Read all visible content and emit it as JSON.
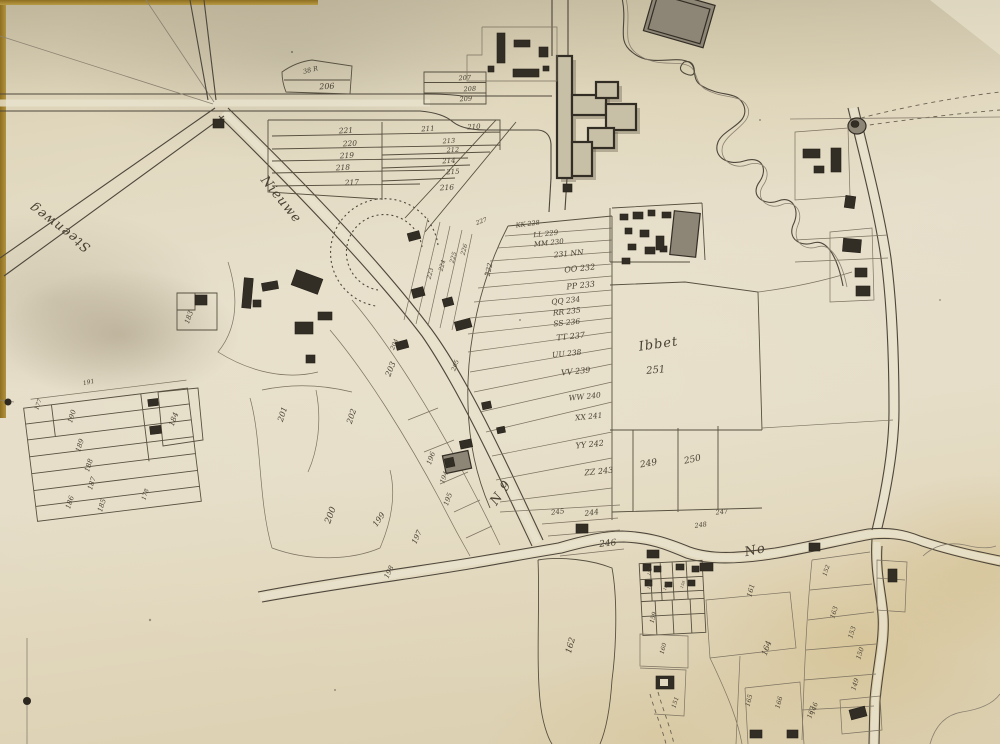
{
  "document": {
    "type": "hand-drawn cadastral survey map",
    "era_style": "ink on aged sepia paper, numbered land parcels, farm buildings, church, winding stream"
  },
  "map": {
    "colors": {
      "paper": "#e2d9c0",
      "ink": "#4a4234",
      "building": "#332e25",
      "stain": "#c9ae6a"
    },
    "labels": {
      "roads": [
        {
          "t": "Steenweg",
          "x": 62,
          "y": 224,
          "r": 217,
          "s": 13
        },
        {
          "t": "Nieuwe",
          "x": 278,
          "y": 202,
          "r": 51,
          "s": 12
        }
      ],
      "places": [
        {
          "t": "Ibbet",
          "x": 659,
          "y": 348,
          "r": -8,
          "s": 15
        },
        {
          "t": "No",
          "x": 756,
          "y": 554,
          "r": -12,
          "s": 12
        },
        {
          "t": "N 9",
          "x": 504,
          "y": 495,
          "r": -55,
          "s": 10
        }
      ],
      "parcels": [
        {
          "t": "38 R",
          "x": 311,
          "y": 72,
          "r": -14,
          "s": 6.5
        },
        {
          "t": "206",
          "x": 327,
          "y": 89,
          "r": -3,
          "s": 8
        },
        {
          "t": "207",
          "x": 465,
          "y": 80,
          "r": -4,
          "s": 6.5
        },
        {
          "t": "208",
          "x": 470,
          "y": 91,
          "r": -4,
          "s": 6.5
        },
        {
          "t": "209",
          "x": 466,
          "y": 101,
          "r": -4,
          "s": 6.5
        },
        {
          "t": "221",
          "x": 346,
          "y": 133,
          "r": -3,
          "s": 7.5
        },
        {
          "t": "220",
          "x": 350,
          "y": 146,
          "r": -3,
          "s": 7.5
        },
        {
          "t": "219",
          "x": 347,
          "y": 158,
          "r": -3,
          "s": 7.5
        },
        {
          "t": "218",
          "x": 343,
          "y": 170,
          "r": -3,
          "s": 7.5
        },
        {
          "t": "217",
          "x": 352,
          "y": 185,
          "r": -3,
          "s": 7.5
        },
        {
          "t": "211",
          "x": 428,
          "y": 131,
          "r": -3,
          "s": 7
        },
        {
          "t": "210",
          "x": 474,
          "y": 129,
          "r": -3,
          "s": 7
        },
        {
          "t": "213",
          "x": 449,
          "y": 143,
          "r": -3,
          "s": 6.5
        },
        {
          "t": "212",
          "x": 453,
          "y": 152,
          "r": -3,
          "s": 6.5
        },
        {
          "t": "214",
          "x": 449,
          "y": 163,
          "r": -3,
          "s": 7
        },
        {
          "t": "215",
          "x": 453,
          "y": 174,
          "r": -3,
          "s": 7
        },
        {
          "t": "216",
          "x": 447,
          "y": 190,
          "r": -3,
          "s": 7.5
        },
        {
          "t": "227",
          "x": 482,
          "y": 223,
          "r": -20,
          "s": 6
        },
        {
          "t": "226",
          "x": 466,
          "y": 250,
          "r": -75,
          "s": 6
        },
        {
          "t": "225",
          "x": 455,
          "y": 258,
          "r": -75,
          "s": 6
        },
        {
          "t": "224",
          "x": 444,
          "y": 266,
          "r": -75,
          "s": 6
        },
        {
          "t": "223",
          "x": 432,
          "y": 274,
          "r": -75,
          "s": 6
        },
        {
          "t": "222",
          "x": 491,
          "y": 270,
          "r": -78,
          "s": 7
        },
        {
          "t": "KK 228",
          "x": 528,
          "y": 226,
          "r": -7,
          "s": 6.5
        },
        {
          "t": "LL 229",
          "x": 546,
          "y": 236,
          "r": -6,
          "s": 7
        },
        {
          "t": "MM 230",
          "x": 549,
          "y": 245,
          "r": -6,
          "s": 7
        },
        {
          "t": "231 NN",
          "x": 569,
          "y": 256,
          "r": -6,
          "s": 7.5
        },
        {
          "t": "OO 232",
          "x": 580,
          "y": 271,
          "r": -6,
          "s": 8
        },
        {
          "t": "PP 233",
          "x": 581,
          "y": 288,
          "r": -6,
          "s": 8
        },
        {
          "t": "QQ 234",
          "x": 566,
          "y": 303,
          "r": -6,
          "s": 7.5
        },
        {
          "t": "RR 235",
          "x": 567,
          "y": 314,
          "r": -6,
          "s": 7.5
        },
        {
          "t": "SS 236",
          "x": 567,
          "y": 325,
          "r": -6,
          "s": 7.5
        },
        {
          "t": "TT 237",
          "x": 571,
          "y": 339,
          "r": -6,
          "s": 8
        },
        {
          "t": "UU 238",
          "x": 567,
          "y": 356,
          "r": -6,
          "s": 7.5
        },
        {
          "t": "VV 239",
          "x": 576,
          "y": 374,
          "r": -6,
          "s": 8
        },
        {
          "t": "WW 240",
          "x": 585,
          "y": 399,
          "r": -6,
          "s": 7.5
        },
        {
          "t": "XX 241",
          "x": 589,
          "y": 419,
          "r": -6,
          "s": 7.5
        },
        {
          "t": "YY 242",
          "x": 590,
          "y": 447,
          "r": -6,
          "s": 8
        },
        {
          "t": "ZZ 243",
          "x": 599,
          "y": 474,
          "r": -6,
          "s": 8
        },
        {
          "t": "249",
          "x": 649,
          "y": 466,
          "r": -10,
          "s": 9
        },
        {
          "t": "250",
          "x": 693,
          "y": 462,
          "r": -12,
          "s": 9
        },
        {
          "t": "245",
          "x": 558,
          "y": 514,
          "r": -8,
          "s": 7
        },
        {
          "t": "244",
          "x": 592,
          "y": 515,
          "r": -8,
          "s": 7.5
        },
        {
          "t": "246",
          "x": 608,
          "y": 546,
          "r": -6,
          "s": 9
        },
        {
          "t": "247",
          "x": 722,
          "y": 514,
          "r": -6,
          "s": 6.5
        },
        {
          "t": "248",
          "x": 701,
          "y": 527,
          "r": -8,
          "s": 6.5
        },
        {
          "t": "251",
          "x": 656,
          "y": 373,
          "r": -5,
          "s": 10
        },
        {
          "t": "203",
          "x": 393,
          "y": 370,
          "r": -68,
          "s": 8
        },
        {
          "t": "204",
          "x": 396,
          "y": 345,
          "r": -68,
          "s": 6
        },
        {
          "t": "205",
          "x": 457,
          "y": 366,
          "r": -70,
          "s": 6
        },
        {
          "t": "202",
          "x": 354,
          "y": 417,
          "r": -72,
          "s": 8
        },
        {
          "t": "201",
          "x": 285,
          "y": 415,
          "r": -72,
          "s": 8
        },
        {
          "t": "200",
          "x": 333,
          "y": 516,
          "r": -70,
          "s": 9
        },
        {
          "t": "199",
          "x": 381,
          "y": 521,
          "r": -55,
          "s": 8
        },
        {
          "t": "198",
          "x": 391,
          "y": 573,
          "r": -65,
          "s": 7
        },
        {
          "t": "197",
          "x": 419,
          "y": 538,
          "r": -65,
          "s": 7.5
        },
        {
          "t": "196",
          "x": 433,
          "y": 459,
          "r": -70,
          "s": 7
        },
        {
          "t": "195",
          "x": 450,
          "y": 500,
          "r": -70,
          "s": 7
        },
        {
          "t": "194",
          "x": 446,
          "y": 478,
          "r": -70,
          "s": 6.5
        },
        {
          "t": "191",
          "x": 89,
          "y": 384,
          "r": -12,
          "s": 6
        },
        {
          "t": "177",
          "x": 40,
          "y": 405,
          "r": -70,
          "s": 6
        },
        {
          "t": "190",
          "x": 74,
          "y": 417,
          "r": -72,
          "s": 7
        },
        {
          "t": "189",
          "x": 82,
          "y": 446,
          "r": -72,
          "s": 7
        },
        {
          "t": "188",
          "x": 91,
          "y": 466,
          "r": -72,
          "s": 7
        },
        {
          "t": "187",
          "x": 94,
          "y": 484,
          "r": -72,
          "s": 7
        },
        {
          "t": "186",
          "x": 72,
          "y": 503,
          "r": -72,
          "s": 7
        },
        {
          "t": "185",
          "x": 104,
          "y": 506,
          "r": -72,
          "s": 7
        },
        {
          "t": "178",
          "x": 147,
          "y": 495,
          "r": -72,
          "s": 6
        },
        {
          "t": "184",
          "x": 176,
          "y": 420,
          "r": -70,
          "s": 7.5
        },
        {
          "t": "183",
          "x": 191,
          "y": 318,
          "r": -70,
          "s": 7
        },
        {
          "t": "162",
          "x": 573,
          "y": 646,
          "r": -75,
          "s": 8.5
        },
        {
          "t": "159",
          "x": 655,
          "y": 618,
          "r": -75,
          "s": 6
        },
        {
          "t": "160",
          "x": 665,
          "y": 649,
          "r": -75,
          "s": 6
        },
        {
          "t": "151",
          "x": 677,
          "y": 703,
          "r": -72,
          "s": 6
        },
        {
          "t": "161",
          "x": 753,
          "y": 591,
          "r": -75,
          "s": 7
        },
        {
          "t": "164",
          "x": 769,
          "y": 649,
          "r": -70,
          "s": 8
        },
        {
          "t": "163",
          "x": 836,
          "y": 613,
          "r": -72,
          "s": 6.5
        },
        {
          "t": "153",
          "x": 854,
          "y": 633,
          "r": -72,
          "s": 6.5
        },
        {
          "t": "150",
          "x": 862,
          "y": 654,
          "r": -72,
          "s": 6.5
        },
        {
          "t": "149",
          "x": 857,
          "y": 685,
          "r": -72,
          "s": 6.5
        },
        {
          "t": "146",
          "x": 816,
          "y": 709,
          "r": -72,
          "s": 6.5
        },
        {
          "t": "165",
          "x": 751,
          "y": 701,
          "r": -75,
          "s": 6.5
        },
        {
          "t": "166",
          "x": 781,
          "y": 703,
          "r": -75,
          "s": 6.5
        },
        {
          "t": "167",
          "x": 813,
          "y": 713,
          "r": -72,
          "s": 6.5
        },
        {
          "t": "152",
          "x": 828,
          "y": 571,
          "r": -72,
          "s": 6
        },
        {
          "t": "155",
          "x": 651,
          "y": 572,
          "r": -70,
          "s": 4
        },
        {
          "t": "156",
          "x": 651,
          "y": 586,
          "r": -70,
          "s": 4
        },
        {
          "t": "157",
          "x": 667,
          "y": 587,
          "r": -70,
          "s": 4
        },
        {
          "t": "158",
          "x": 684,
          "y": 585,
          "r": -70,
          "s": 4
        }
      ]
    }
  }
}
